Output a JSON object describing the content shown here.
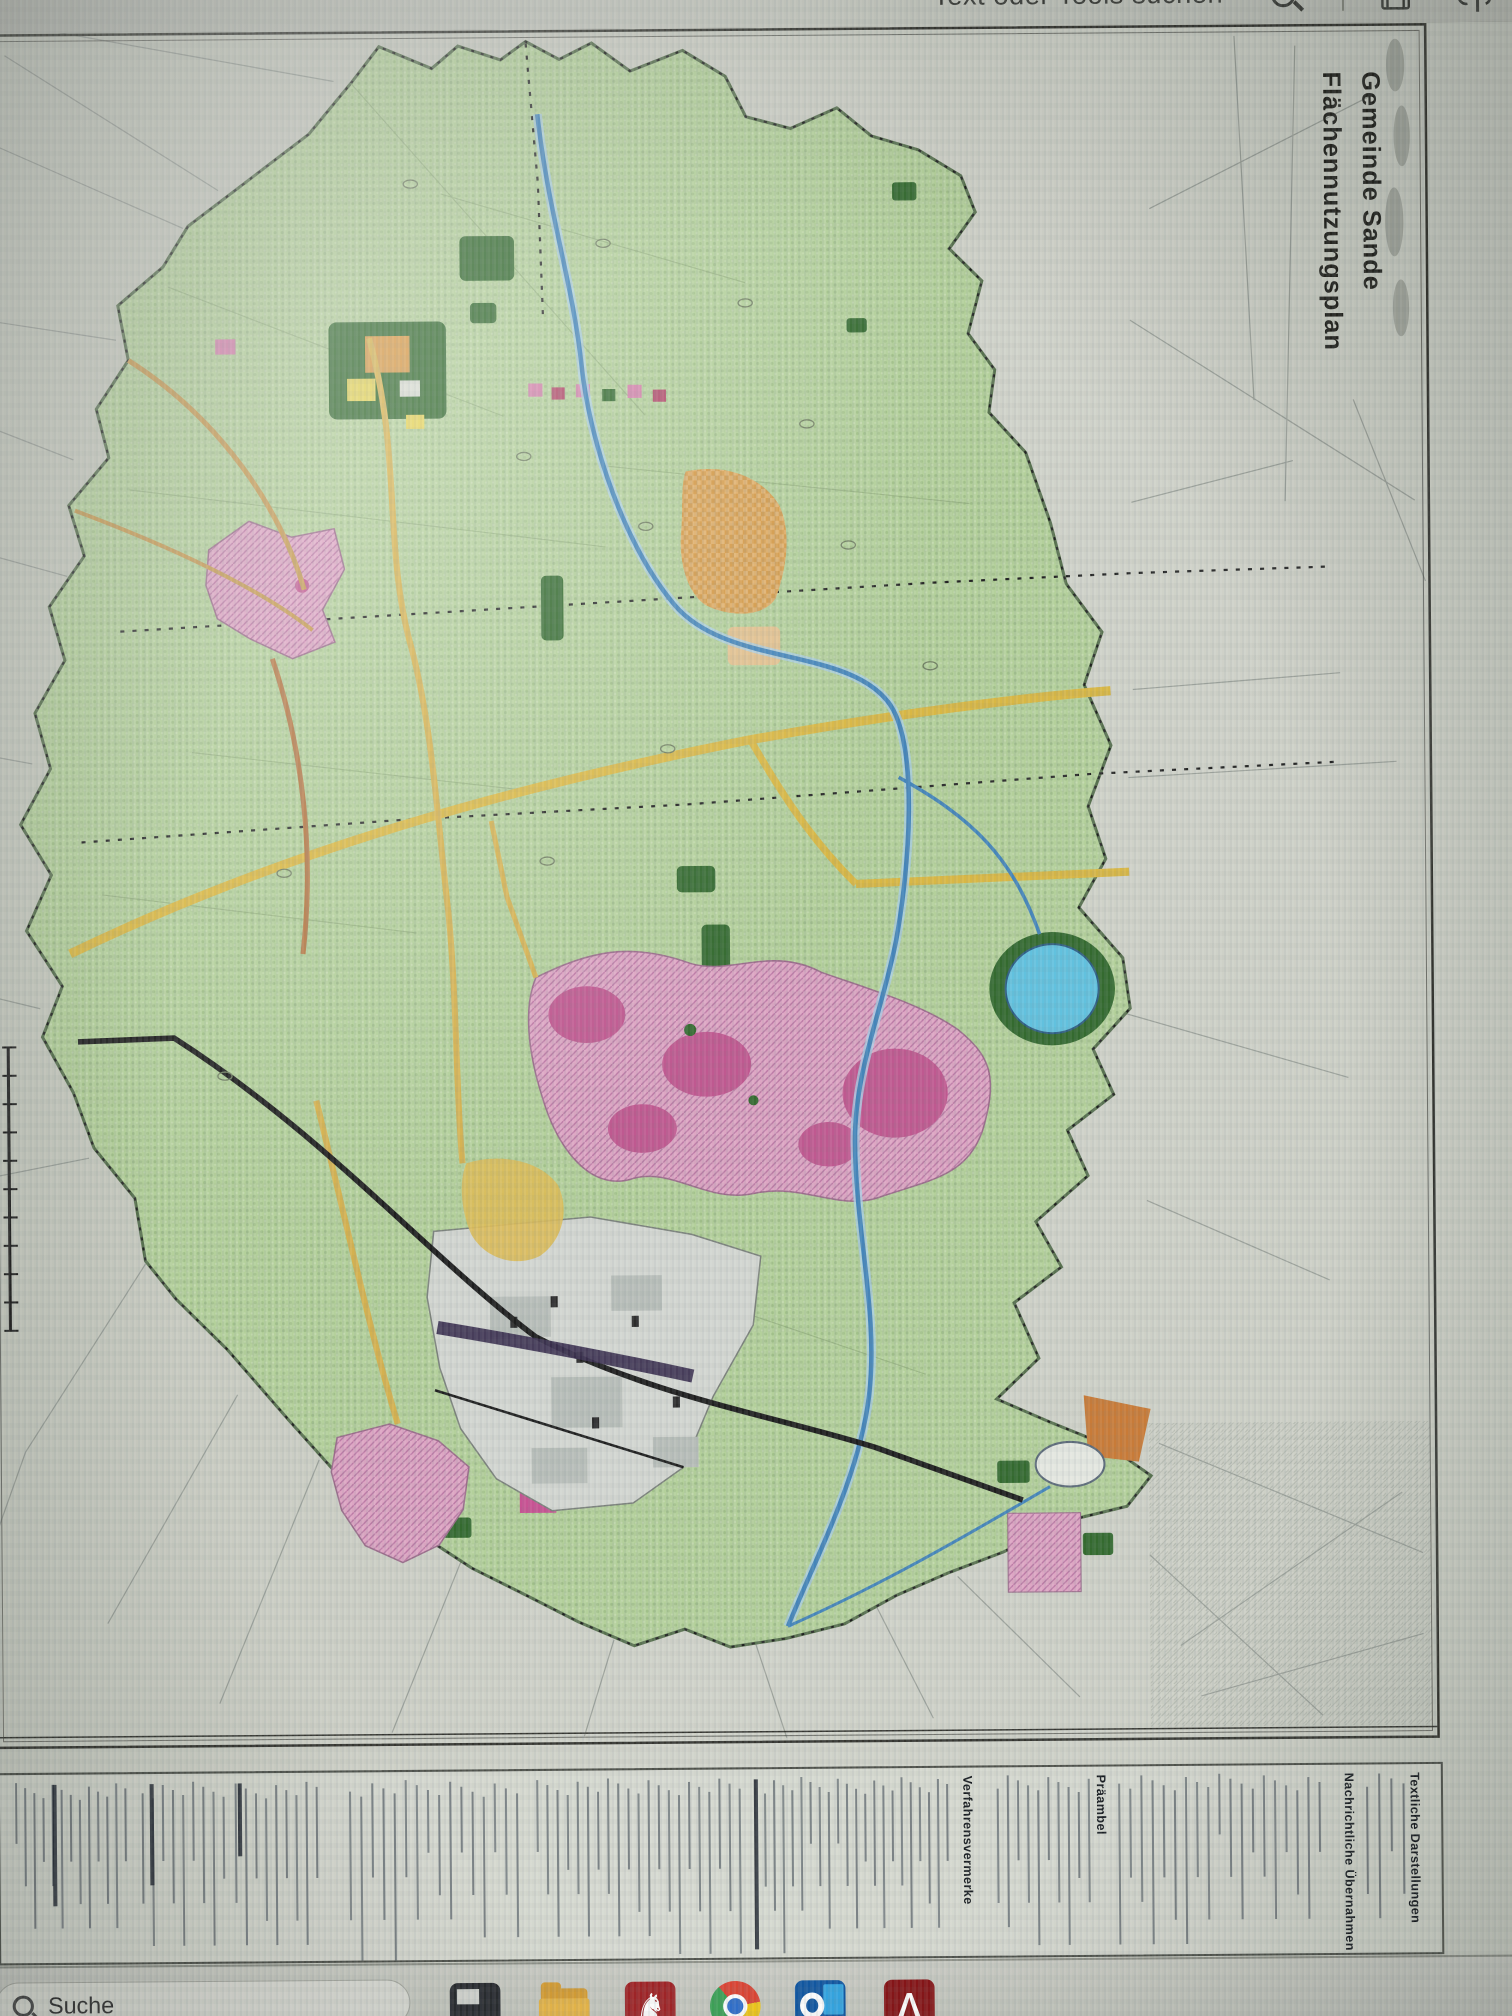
{
  "viewer_toolbar": {
    "search_label": "Text oder Tools suchen",
    "icons": [
      "search-icon",
      "save-icon",
      "share-upload-icon"
    ]
  },
  "document": {
    "title_line1": "Gemeinde Sande",
    "title_line2": "Flächennutzungsplan",
    "legend_headers": {
      "verfahrensvermerke": "Verfahrensvermerke",
      "praeambel": "Präambel",
      "nachrichtliche_uebernahmen": "Nachrichtliche Übernahmen",
      "textliche_darstellungen": "Textliche Darstellungen"
    }
  },
  "map": {
    "palette": {
      "municipality_green": "#b3d298",
      "forest_dark_green": "#2f6b2a",
      "residential_pink": "#e2a6c6",
      "mixed_use_magenta": "#c75693",
      "special_orange": "#d9993f",
      "industrial_gray": "#d4d8d2",
      "water_blue": "#3f86c0",
      "lake_cyan": "#5bc4e4",
      "road_yellow": "#ddb83a",
      "railway_black": "#1c1c1c"
    },
    "features": [
      "municipality-boundary",
      "forest-areas",
      "residential-areas",
      "special-building-areas",
      "industrial-area",
      "river-and-canals",
      "lake",
      "road-network",
      "railway-lines",
      "scale-bar"
    ]
  },
  "taskbar": {
    "search_label": "Suche",
    "icons": [
      "windows-search-icon",
      "pinned-app-dark-icon",
      "file-explorer-icon",
      "niedersachsen-horse-icon",
      "chrome-icon",
      "outlook-icon",
      "acrobat-icon"
    ]
  }
}
